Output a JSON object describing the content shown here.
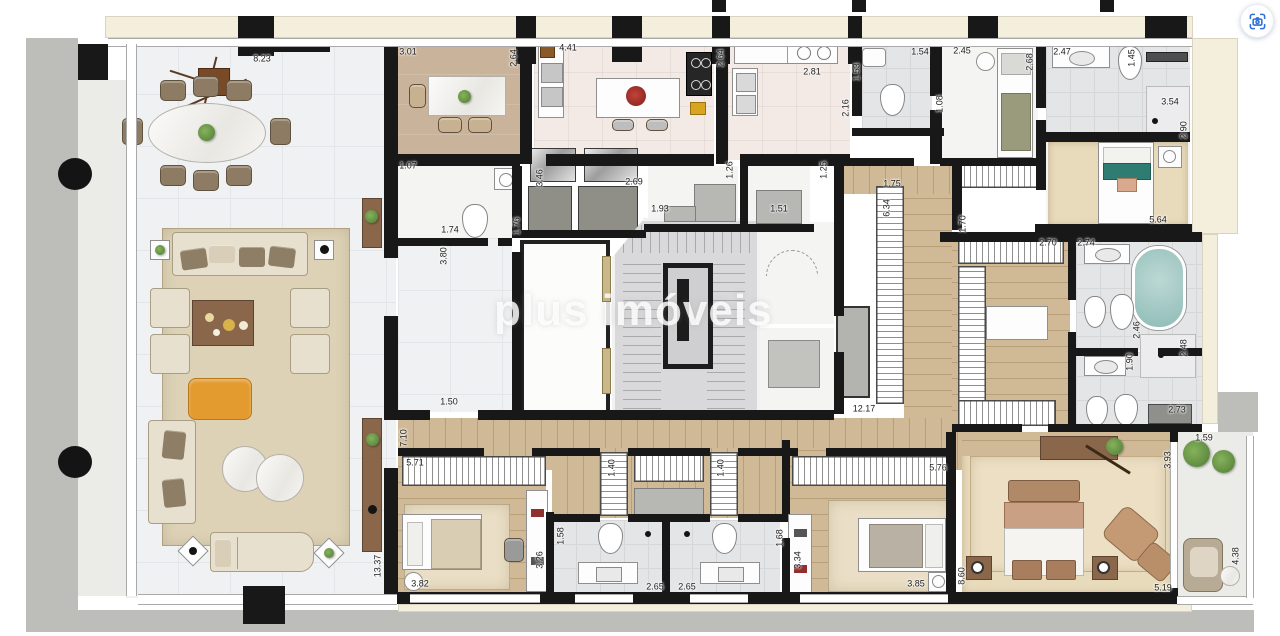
{
  "page": {
    "watermark": "plus imóveis"
  },
  "controls": {
    "visual_search_button": {
      "icon": "camera-visual-search-icon",
      "accent_color": "#3070d8"
    }
  },
  "plan": {
    "type": "apartment-floor-plan",
    "dimension_unit": "m",
    "dimension_labels": [
      {
        "t": "8.23",
        "x": 262,
        "y": 59,
        "r": 0
      },
      {
        "t": "3.01",
        "x": 408,
        "y": 52,
        "r": 0
      },
      {
        "t": "2.64",
        "x": 514,
        "y": 58,
        "r": 1
      },
      {
        "t": "4.41",
        "x": 568,
        "y": 48,
        "r": 0
      },
      {
        "t": "2.64",
        "x": 721,
        "y": 58,
        "r": 1
      },
      {
        "t": "2.81",
        "x": 812,
        "y": 72,
        "r": 0
      },
      {
        "t": "1.53",
        "x": 857,
        "y": 72,
        "r": 1
      },
      {
        "t": "1.54",
        "x": 920,
        "y": 52,
        "r": 0
      },
      {
        "t": "2.45",
        "x": 962,
        "y": 51,
        "r": 0
      },
      {
        "t": "2.16",
        "x": 846,
        "y": 108,
        "r": 1
      },
      {
        "t": "1.08",
        "x": 940,
        "y": 104,
        "r": 1
      },
      {
        "t": "2.68",
        "x": 1030,
        "y": 62,
        "r": 1
      },
      {
        "t": "2.47",
        "x": 1062,
        "y": 52,
        "r": 0
      },
      {
        "t": "1.45",
        "x": 1132,
        "y": 58,
        "r": 1
      },
      {
        "t": "3.54",
        "x": 1170,
        "y": 102,
        "r": 0
      },
      {
        "t": "2.90",
        "x": 1184,
        "y": 130,
        "r": 1
      },
      {
        "t": "5.64",
        "x": 1158,
        "y": 220,
        "r": 0
      },
      {
        "t": "1.07",
        "x": 408,
        "y": 166,
        "r": 0
      },
      {
        "t": "3.46",
        "x": 540,
        "y": 178,
        "r": 1
      },
      {
        "t": "2.69",
        "x": 634,
        "y": 182,
        "r": 0
      },
      {
        "t": "1.74",
        "x": 450,
        "y": 230,
        "r": 0
      },
      {
        "t": "1.76",
        "x": 517,
        "y": 226,
        "r": 1
      },
      {
        "t": "3.80",
        "x": 444,
        "y": 256,
        "r": 1
      },
      {
        "t": "1.93",
        "x": 660,
        "y": 209,
        "r": 0
      },
      {
        "t": "1.26",
        "x": 730,
        "y": 170,
        "r": 1
      },
      {
        "t": "1.51",
        "x": 779,
        "y": 209,
        "r": 0
      },
      {
        "t": "1.25",
        "x": 824,
        "y": 170,
        "r": 1
      },
      {
        "t": "1.75",
        "x": 892,
        "y": 184,
        "r": 0
      },
      {
        "t": "6.34",
        "x": 887,
        "y": 208,
        "r": 1
      },
      {
        "t": "1.70",
        "x": 963,
        "y": 224,
        "r": 1
      },
      {
        "t": "2.70",
        "x": 1048,
        "y": 243,
        "r": 0
      },
      {
        "t": "2.74",
        "x": 1086,
        "y": 243,
        "r": 0
      },
      {
        "t": "2.46",
        "x": 1137,
        "y": 330,
        "r": 1
      },
      {
        "t": "2.48",
        "x": 1184,
        "y": 348,
        "r": 1
      },
      {
        "t": "1.90",
        "x": 1130,
        "y": 362,
        "r": 1
      },
      {
        "t": "2.73",
        "x": 1177,
        "y": 410,
        "r": 0
      },
      {
        "t": "1.50",
        "x": 449,
        "y": 402,
        "r": 0
      },
      {
        "t": "12.17",
        "x": 864,
        "y": 409,
        "r": 0
      },
      {
        "t": "7.10",
        "x": 404,
        "y": 438,
        "r": 1
      },
      {
        "t": "5.71",
        "x": 415,
        "y": 463,
        "r": 0
      },
      {
        "t": "1.40",
        "x": 612,
        "y": 468,
        "r": 1
      },
      {
        "t": "1.40",
        "x": 721,
        "y": 468,
        "r": 1
      },
      {
        "t": "5.76",
        "x": 938,
        "y": 468,
        "r": 0
      },
      {
        "t": "13.37",
        "x": 378,
        "y": 566,
        "r": 1
      },
      {
        "t": "3.82",
        "x": 420,
        "y": 584,
        "r": 0
      },
      {
        "t": "3.26",
        "x": 540,
        "y": 560,
        "r": 1
      },
      {
        "t": "1.58",
        "x": 561,
        "y": 536,
        "r": 1
      },
      {
        "t": "2.65",
        "x": 655,
        "y": 587,
        "r": 0
      },
      {
        "t": "2.65",
        "x": 687,
        "y": 587,
        "r": 0
      },
      {
        "t": "1.68",
        "x": 780,
        "y": 538,
        "r": 1
      },
      {
        "t": "3.34",
        "x": 798,
        "y": 560,
        "r": 1
      },
      {
        "t": "3.85",
        "x": 916,
        "y": 584,
        "r": 0
      },
      {
        "t": "8.60",
        "x": 962,
        "y": 576,
        "r": 1
      },
      {
        "t": "5.19",
        "x": 1163,
        "y": 588,
        "r": 0
      },
      {
        "t": "3.93",
        "x": 1168,
        "y": 460,
        "r": 1
      },
      {
        "t": "1.59",
        "x": 1204,
        "y": 438,
        "r": 0
      },
      {
        "t": "4.38",
        "x": 1236,
        "y": 556,
        "r": 1
      }
    ]
  },
  "colors": {
    "wall": "#181818",
    "marble_floor": "#eff1f2",
    "wood_floor": "#cfb996",
    "carpet": "#e8dbbc",
    "terrace_band": "#f4eedc",
    "concrete_band": "#bdbdba",
    "bath_tile": "#e4e5e7",
    "accent_ottoman": "#e39b2f",
    "accent_teal": "#2f7c72",
    "bathtub": "#aecfcb",
    "plant_green": "#5d8f3f"
  }
}
